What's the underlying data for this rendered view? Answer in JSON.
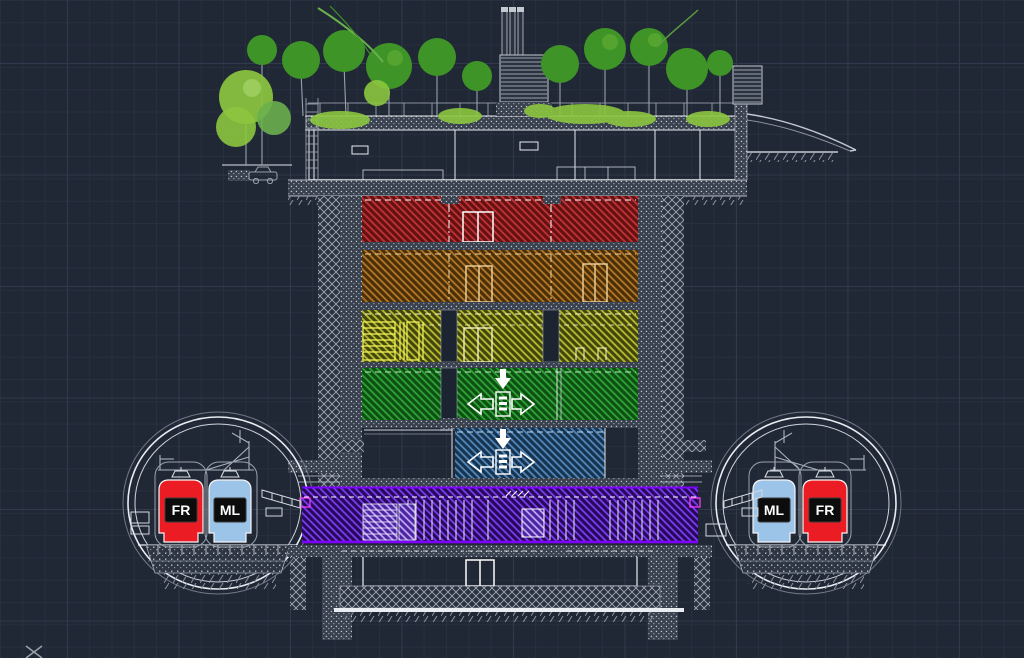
{
  "viewport": {
    "type": "cad-model-space-section-view"
  },
  "tunnels": {
    "left": {
      "outer_label": "FR",
      "inner_label": "ML"
    },
    "right": {
      "inner_label": "ML",
      "outer_label": "FR"
    }
  },
  "colors": {
    "fr_train": "#ec1c24",
    "ml_train": "#9cc3e8",
    "label_bg": "#0c0c0c",
    "label_text": "#ffffff",
    "level1_red": "#c23434",
    "level2_brown": "#b5782a",
    "level3_yellow": "#b9bd32",
    "level4_green": "#2fa437",
    "level5_blue": "#5388bd",
    "level6_purple": "#7d3cf2",
    "structure_gray": "#c3c9d1",
    "tree_dark": "#3f9427",
    "tree_light": "#8cc63f",
    "background": "#202735"
  }
}
